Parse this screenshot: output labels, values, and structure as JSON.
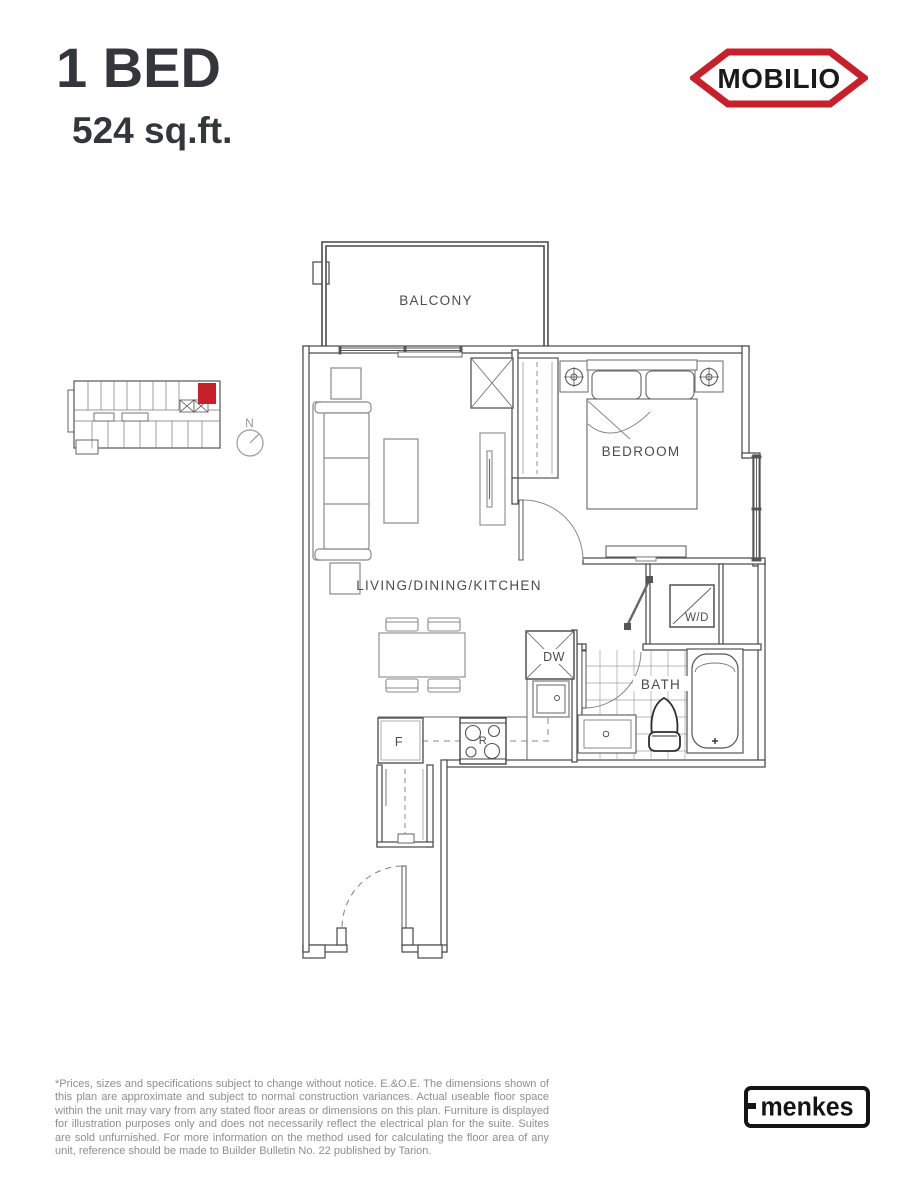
{
  "header": {
    "title": "1 BED",
    "area": "524 sq.ft.",
    "brand": "MOBILIO"
  },
  "colors": {
    "accent_red": "#c8202a",
    "ink": "#33363b",
    "plan_line": "#474747",
    "disclaimer_gray": "#8e8e8e"
  },
  "keyplan": {
    "north_label": "N"
  },
  "floorplan": {
    "room_labels": {
      "balcony": "BALCONY",
      "bedroom": "BEDROOM",
      "living": "LIVING/DINING/KITCHEN",
      "bath": "BATH"
    },
    "fixture_labels": {
      "washer_dryer": "W/D",
      "dishwasher": "DW",
      "fridge": "F",
      "range": "R"
    }
  },
  "footer": {
    "disclaimer": "*Prices, sizes and specifications subject to change without notice. E.&O.E. The dimensions shown of this plan are approximate and subject to normal construction variances. Actual useable floor space within the unit may vary from any stated floor areas or dimensions on this plan. Furniture is displayed for illustration purposes only and does not necessarily reflect the electrical plan for the suite. Suites are sold unfurnished. For more information on the method used for calculating the floor area of any unit, reference should be made to Builder Bulletin No. 22 published by Tarion.",
    "builder": "menkes"
  }
}
